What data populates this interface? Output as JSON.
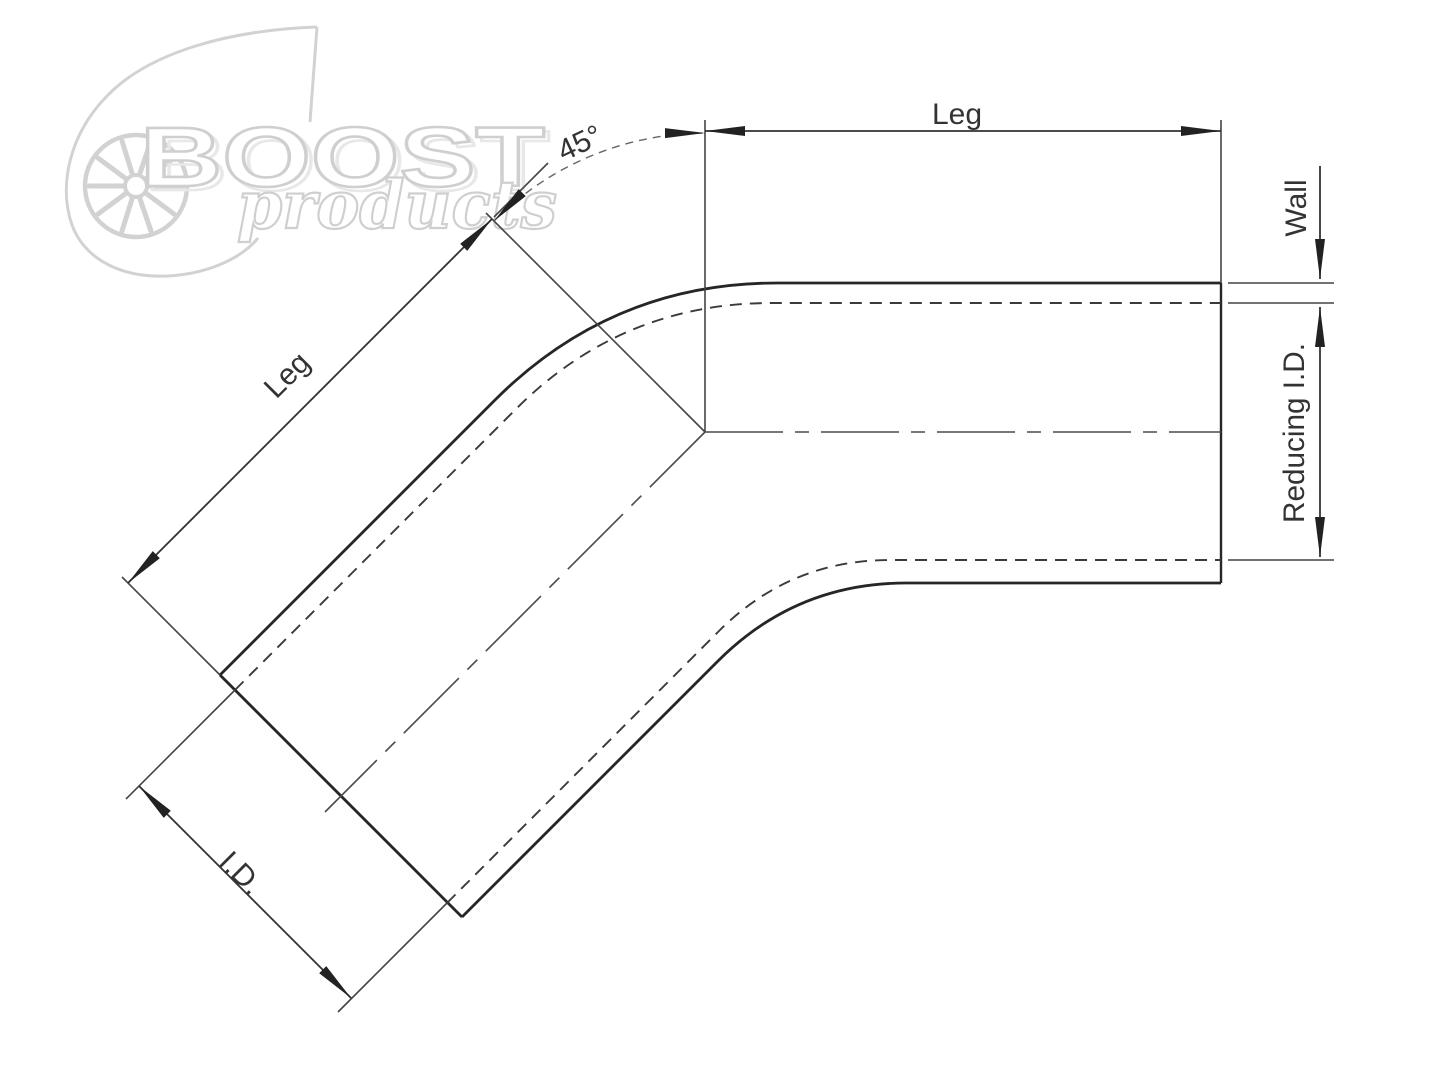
{
  "page": {
    "background_color": "#ffffff",
    "description_labels_only": "technical dimension drawing"
  },
  "watermark": {
    "brand": "BOOST",
    "tagline": "products",
    "color": "#d0d0d0"
  },
  "labels": {
    "angle": "45°",
    "leg_top": "Leg",
    "leg_diagonal": "Leg",
    "wall": "Wall",
    "reducing_id": "Reducing I.D.",
    "id": "I.D."
  },
  "colors": {
    "outline": "#262626",
    "hidden_line": "#3a3a3a",
    "centerline": "#4a4a4a",
    "dimension_line": "#333333",
    "arrowhead": "#222222",
    "label_text": "#333333",
    "watermark_gray": "#d0d0d0"
  }
}
